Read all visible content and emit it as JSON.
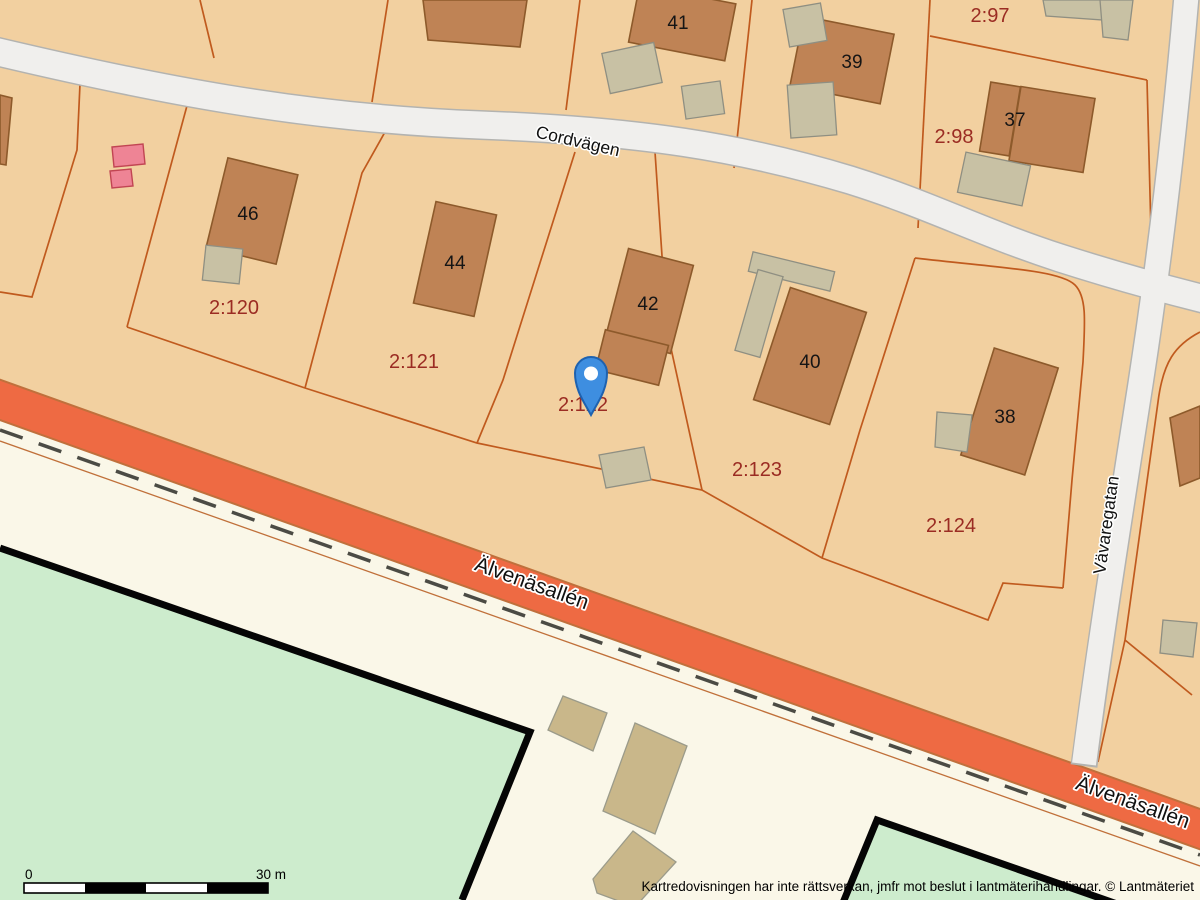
{
  "map_type": "cadastral-map",
  "streets": {
    "cordvagen": "Cordvägen",
    "vavaregatan": "Vävaregatan",
    "alvenasallen_upper": "Älvenäsallén",
    "alvenasallen_lower": "Älvenäsallén"
  },
  "parcels": [
    {
      "id": "2:97"
    },
    {
      "id": "2:98"
    },
    {
      "id": "2:120"
    },
    {
      "id": "2:121"
    },
    {
      "id": "2:122"
    },
    {
      "id": "2:123"
    },
    {
      "id": "2:124"
    }
  ],
  "house_numbers": [
    "41",
    "39",
    "37",
    "46",
    "44",
    "42",
    "40",
    "38"
  ],
  "scale_bar": {
    "start_label": "0",
    "end_label": "30 m"
  },
  "attribution": "Kartredovisningen har inte rättsverkan, jmfr mot beslut i lantmäterihandlingar. © Lantmäteriet",
  "colors": {
    "parcel_fill": "#f2d0a0",
    "parcel_line": "#c05a1e",
    "road_fill": "#f0efed",
    "road_casing": "#b3b3b0",
    "avenue_orange": "#ee6a43",
    "offwhite_ground": "#faf7e8",
    "field_green": "#cdeccd",
    "house_brown": "#bf8355",
    "shed_beige": "#c8c1a4",
    "khaki_building": "#c9b78a",
    "pink_building": "#ee8495",
    "parcel_label_red": "#9b2c23",
    "pin_blue": "#3e8ee0"
  }
}
